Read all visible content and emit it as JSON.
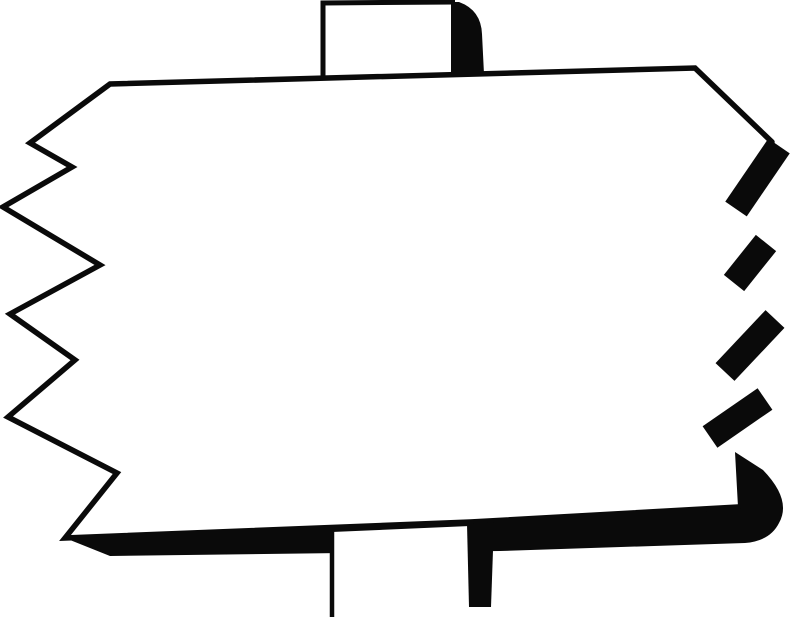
{
  "canvas": {
    "width": 800,
    "height": 621,
    "background": "#ffffff",
    "ink": "#0a0a0a"
  },
  "artwork": {
    "title": "Blank jagged-edge signboard on a post",
    "description": "Hand-drawn black ink clipart of an empty rectangular sign with torn zigzag left and right edges, a short post stub above, a post below, and thick cast-shadow strokes along the right and bottom edges.",
    "panel": {
      "fill": "#ffffff",
      "points": "110,84 695,68 772,142 740,508 65,538 117,473 8,417 75,360 10,314 100,265 3,207 72,167 30,143"
    },
    "outline": {
      "stroke_width": 5.5,
      "path": "M772,142 L695,68 L110,84 L30,143 L72,167 L3,207 L100,265 L10,314 L75,360 L8,417 L117,473 L65,538 L470,522 L738,507"
    },
    "shadow_teeth": {
      "stroke_width": 26,
      "segments": [
        {
          "x1": 779,
          "y1": 146,
          "x2": 736,
          "y2": 209
        },
        {
          "x1": 766,
          "y1": 243,
          "x2": 734,
          "y2": 283
        },
        {
          "x1": 775,
          "y1": 319,
          "x2": 725,
          "y2": 372
        },
        {
          "x1": 765,
          "y1": 399,
          "x2": 710,
          "y2": 437
        }
      ]
    },
    "shadow_corner_path": "M735,452 L763,470 Q792,500 779,523 Q770,541 745,543 L500,551 L110,556 L65,538 L470,522 L738,507 Z",
    "top_post": {
      "body_points": "323,3 455,2 482,74 323,78",
      "outline_path": "M323,78 L323,3 L455,2",
      "outline_width": 5,
      "shadow_path": "M451,2 L459,2 Q481,10 482,34 L484,74 L451,74 Z"
    },
    "bottom_post": {
      "body_points": "332,532 470,526 470,621 332,621",
      "left_edge_path": "M332,530 L332,617",
      "left_edge_width": 4.5,
      "shadow_path": "M467,524 L494,522 L491,607 L469,607 Z"
    }
  }
}
